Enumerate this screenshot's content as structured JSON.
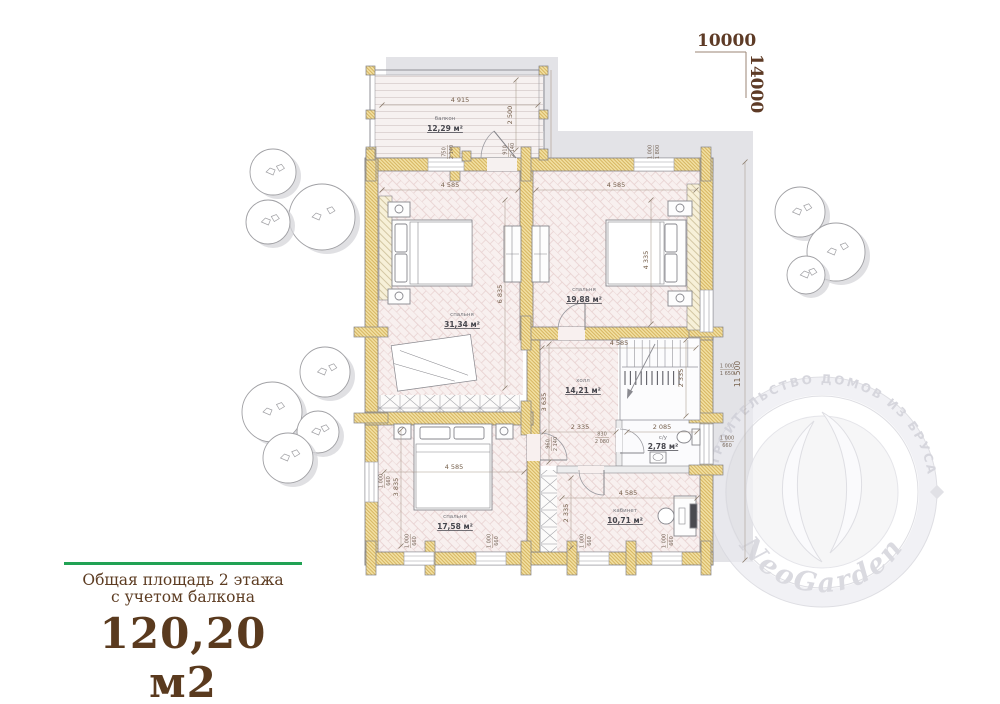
{
  "site_plan": {
    "overall_width": "10000",
    "overall_height": "14000"
  },
  "summary": {
    "title_line1": "Общая площадь 2 этажа",
    "title_line2": "с учетом балкона",
    "total_area": "120,20 м2"
  },
  "watermark": {
    "arc_text": "СТРОИТЕЛЬСТВО ДОМОВ ИЗ БРУСА",
    "brand": "NeoGarden"
  },
  "rooms": {
    "balcony": {
      "name": "балкон",
      "area": "12,29 м²"
    },
    "bedroom1": {
      "name": "спальня",
      "area": "31,34 м²"
    },
    "bedroom2": {
      "name": "спальня",
      "area": "19,88 м²"
    },
    "hall": {
      "name": "холл",
      "area": "14,21 м²"
    },
    "wc": {
      "name": "с/у",
      "area": "2,78 м²"
    },
    "office": {
      "name": "кабинет",
      "area": "10,71 м²"
    },
    "bedroom3": {
      "name": "спальня",
      "area": "17,58 м²"
    }
  },
  "dims": {
    "d4915": "4 915",
    "d2500": "2 500",
    "d4585": "4 585",
    "d6835": "6 835",
    "d4335": "4 335",
    "d2335": "2 335",
    "d3635": "3 635",
    "d2085": "2 085",
    "d3835": "3 835",
    "d11500": "11 500"
  },
  "openings": {
    "n1000": "1 000",
    "n660": "660",
    "n1650": "1 650",
    "n1800": "1 800",
    "n750": "750",
    "n910": "910",
    "n2140": "2 140",
    "n830": "830",
    "n2080": "2 080",
    "n960": "960"
  },
  "colors": {
    "wall_fill": "#f2e0a2",
    "wall_hatch": "#cda74b",
    "floor_line": "#e6cecd",
    "shadow": "#e3e3e7",
    "accent_green": "#21a254",
    "title_brown": "#5d3c22",
    "dim_text": "#76604c"
  }
}
